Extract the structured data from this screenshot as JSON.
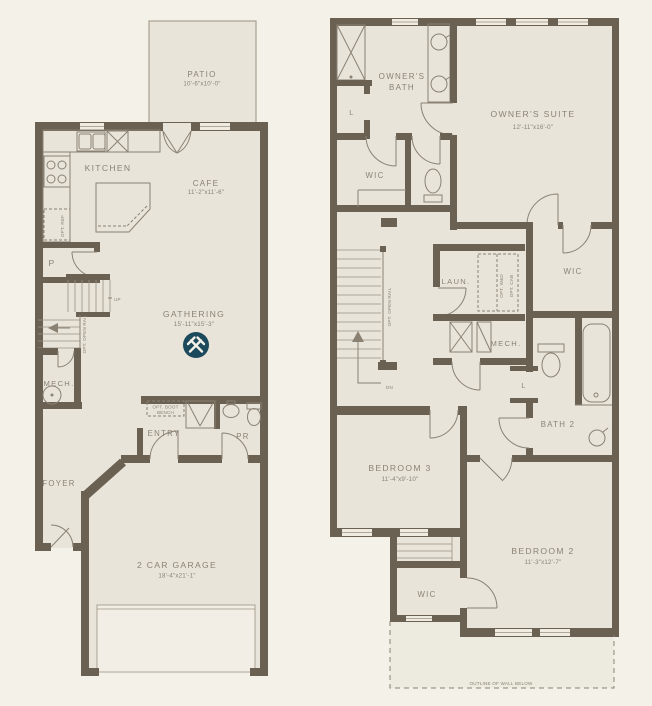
{
  "colors": {
    "background": "#f4f1e8",
    "room_fill": "#e8e4da",
    "wall": "#6a6153",
    "line": "#8a8173",
    "label_text": "#8b8274",
    "logo": "#1c4a5c"
  },
  "floor1": {
    "patio": {
      "label": "PATIO",
      "dims": "10'-6\"x10'-0\""
    },
    "kitchen": {
      "label": "KITCHEN"
    },
    "cafe": {
      "label": "CAFE",
      "dims": "11'-2\"x11'-6\""
    },
    "gathering": {
      "label": "GATHERING",
      "dims": "15'-11\"x15'-3\""
    },
    "pantry": {
      "label": "P"
    },
    "mech": {
      "label": "MECH."
    },
    "entry": {
      "label": "ENTRY"
    },
    "powder_room": {
      "label": "PR"
    },
    "foyer": {
      "label": "FOYER"
    },
    "garage": {
      "label": "2 CAR GARAGE",
      "dims": "18'-4\"x21'-1\""
    },
    "stairs": {
      "up": "UP",
      "opt_open_rail": "OPT. OPEN RAIL"
    },
    "options": {
      "opt_ref": "OPT. REF",
      "opt_boot_bench_line1": "OPT. BOOT",
      "opt_boot_bench_line2": "BENCH"
    }
  },
  "floor2": {
    "owners_bath": {
      "line1": "OWNER'S",
      "line2": "BATH"
    },
    "owners_suite": {
      "label": "OWNER'S SUITE",
      "dims": "12'-11\"x16'-0\""
    },
    "wic_owners": {
      "label": "WIC"
    },
    "wic_hall": {
      "label": "WIC"
    },
    "wic_bedroom2": {
      "label": "WIC"
    },
    "laundry": {
      "label": "LAUN."
    },
    "mech": {
      "label": "MECH."
    },
    "bath2": {
      "label": "BATH 2"
    },
    "bedroom3": {
      "label": "BEDROOM 3",
      "dims": "11'-4\"x9'-10\""
    },
    "bedroom2": {
      "label": "BEDROOM 2",
      "dims": "11'-3\"x12'-7\""
    },
    "linen_bath": {
      "label": "L"
    },
    "linen_bath2": {
      "label": "L"
    },
    "stairs": {
      "dn": "DN",
      "opt_open_rail": "OPT. OPEN RAIL"
    },
    "options": {
      "opt_wd": "OPT. W&D",
      "opt_cab": "OPT. CAB"
    },
    "outline_note": "OUTLINE OF WALL BELOW"
  }
}
